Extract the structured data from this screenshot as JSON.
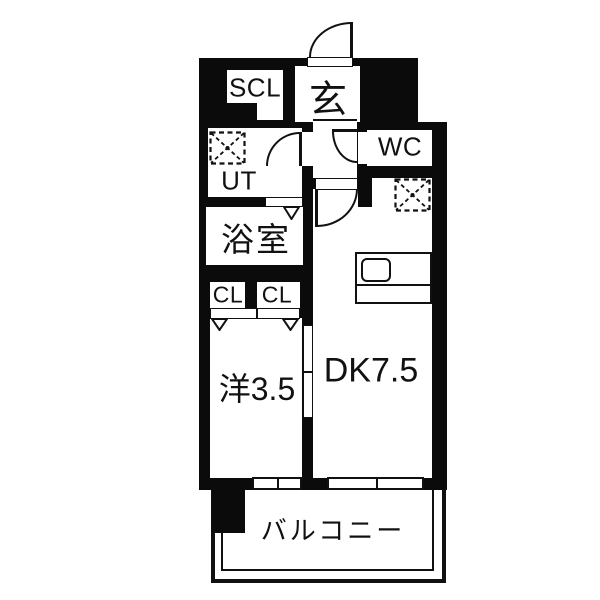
{
  "plan": {
    "rooms": {
      "scl": {
        "label": "SCL"
      },
      "genkan": {
        "label": "玄"
      },
      "wc": {
        "label": "WC"
      },
      "ut": {
        "label": "UT"
      },
      "bathroom": {
        "label": "浴室"
      },
      "closet_left": {
        "label": "CL"
      },
      "closet_right": {
        "label": "CL"
      },
      "western_room": {
        "label": "洋3.5"
      },
      "dining_kitchen": {
        "label": "DK7.5"
      },
      "balcony": {
        "label": "バルコニー"
      }
    },
    "colors": {
      "wall": "#0b0b0b",
      "floor": "#ffffff",
      "background": "#ffffff"
    }
  }
}
